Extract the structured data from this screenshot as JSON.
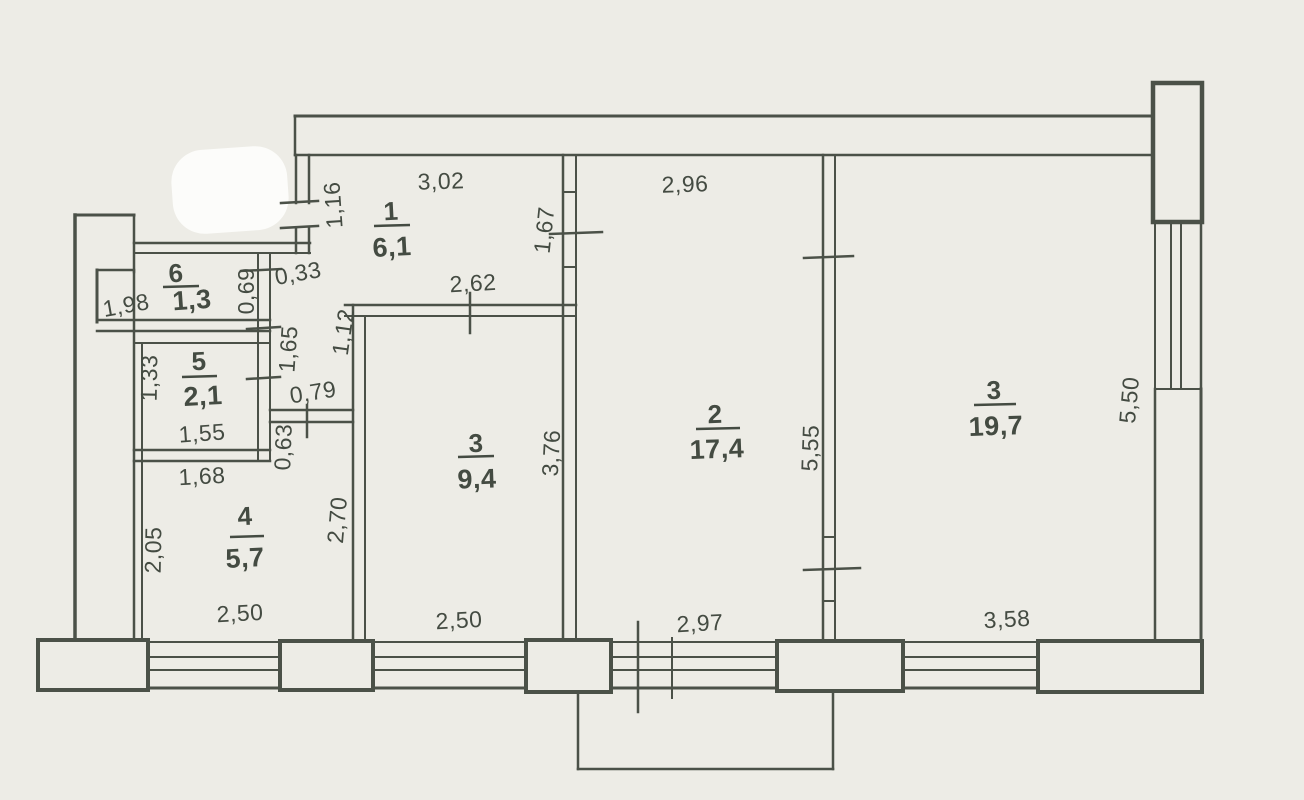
{
  "document": {
    "type": "scanned apartment floor plan",
    "background": "#edece6",
    "line_color": "#4b5148",
    "text_color": "#444b42",
    "erasure_color": "#fcfcfa"
  },
  "plan": {
    "rooms": [
      {
        "number": "1",
        "area": "6,1",
        "nx": 391,
        "ny": 211,
        "ulx1": 374,
        "ulx2": 410,
        "uly": 226,
        "ax": 392,
        "ay": 247,
        "rot": -3
      },
      {
        "number": "6",
        "area": "1,3",
        "nx": 176,
        "ny": 273,
        "ulx1": 163,
        "ulx2": 199,
        "uly": 287,
        "ax": 192,
        "ay": 300,
        "rot": -4
      },
      {
        "number": "5",
        "area": "2,1",
        "nx": 199,
        "ny": 361,
        "ulx1": 182,
        "ulx2": 217,
        "uly": 377,
        "ax": 203,
        "ay": 396,
        "rot": -3
      },
      {
        "number": "4",
        "area": "5,7",
        "nx": 245,
        "ny": 516,
        "ulx1": 230,
        "ulx2": 264,
        "uly": 537,
        "ax": 245,
        "ay": 558,
        "rot": -3
      },
      {
        "number": "3",
        "area": "9,4",
        "nx": 476,
        "ny": 443,
        "ulx1": 458,
        "ulx2": 494,
        "uly": 457,
        "ax": 477,
        "ay": 479,
        "rot": -2
      },
      {
        "number": "2",
        "area": "17,4",
        "nx": 715,
        "ny": 414,
        "ulx1": 696,
        "ulx2": 740,
        "uly": 429,
        "ax": 717,
        "ay": 449,
        "rot": -2
      },
      {
        "number": "3",
        "area": "19,7",
        "nx": 994,
        "ny": 390,
        "ulx1": 974,
        "ulx2": 1016,
        "uly": 405,
        "ax": 996,
        "ay": 426,
        "rot": -2
      }
    ],
    "dimensions": [
      {
        "t": "3,02",
        "x": 441,
        "y": 181,
        "r": -2
      },
      {
        "t": "2,96",
        "x": 685,
        "y": 184,
        "r": -2
      },
      {
        "t": "1,16",
        "x": 333,
        "y": 205,
        "r": -94
      },
      {
        "t": "1,67",
        "x": 544,
        "y": 230,
        "r": -84
      },
      {
        "t": "1,98",
        "x": 126,
        "y": 305,
        "r": -10
      },
      {
        "t": "0,69",
        "x": 246,
        "y": 291,
        "r": -90,
        "fs": 19
      },
      {
        "t": "0,33",
        "x": 298,
        "y": 273,
        "r": -10,
        "fs": 19
      },
      {
        "t": "1,65",
        "x": 288,
        "y": 349,
        "r": -86
      },
      {
        "t": "1,12",
        "x": 343,
        "y": 332,
        "r": -82
      },
      {
        "t": "2,62",
        "x": 473,
        "y": 283,
        "r": -3
      },
      {
        "t": "1,33",
        "x": 149,
        "y": 378,
        "r": -89
      },
      {
        "t": "0,79",
        "x": 313,
        "y": 392,
        "r": -9,
        "fs": 20
      },
      {
        "t": "1,55",
        "x": 202,
        "y": 433,
        "r": -4
      },
      {
        "t": "0,63",
        "x": 283,
        "y": 447,
        "r": -88,
        "fs": 19
      },
      {
        "t": "1,68",
        "x": 202,
        "y": 476,
        "r": -3
      },
      {
        "t": "2,05",
        "x": 153,
        "y": 550,
        "r": -89
      },
      {
        "t": "2,70",
        "x": 337,
        "y": 520,
        "r": -85
      },
      {
        "t": "3,76",
        "x": 551,
        "y": 453,
        "r": -87
      },
      {
        "t": "5,55",
        "x": 810,
        "y": 448,
        "r": -88
      },
      {
        "t": "5,50",
        "x": 1129,
        "y": 400,
        "r": -85
      },
      {
        "t": "2,50",
        "x": 240,
        "y": 613,
        "r": -3
      },
      {
        "t": "2,50",
        "x": 459,
        "y": 620,
        "r": -3
      },
      {
        "t": "2,97",
        "x": 700,
        "y": 623,
        "r": -3
      },
      {
        "t": "3,58",
        "x": 1007,
        "y": 619,
        "r": -3
      }
    ],
    "walls": [
      [
        295,
        116,
        1153,
        116,
        3
      ],
      [
        295,
        155,
        1153,
        155,
        2.5
      ],
      [
        295,
        116,
        295,
        155,
        2.5
      ],
      [
        75,
        215,
        75,
        641,
        3.5
      ],
      [
        75,
        215,
        134,
        215,
        3
      ],
      [
        134,
        215,
        134,
        272,
        2.5
      ],
      [
        97,
        270,
        134,
        270,
        2.5
      ],
      [
        97,
        270,
        97,
        322,
        3
      ],
      [
        134,
        272,
        134,
        641,
        2.5
      ],
      [
        142,
        343,
        142,
        641,
        2
      ],
      [
        134,
        243,
        310,
        243,
        2.5
      ],
      [
        134,
        253,
        310,
        253,
        2
      ],
      [
        97,
        320,
        270,
        320,
        2.5
      ],
      [
        97,
        331,
        270,
        331,
        2.5
      ],
      [
        134,
        343,
        270,
        343,
        2
      ],
      [
        134,
        450,
        270,
        450,
        2.5
      ],
      [
        134,
        461,
        270,
        461,
        2.5
      ],
      [
        258,
        253,
        258,
        461,
        2
      ],
      [
        270,
        253,
        270,
        461,
        2
      ],
      [
        270,
        410,
        353,
        410,
        2.5
      ],
      [
        270,
        422,
        353,
        422,
        2.5
      ],
      [
        296,
        155,
        296,
        203,
        2.5
      ],
      [
        309,
        155,
        309,
        203,
        2.5
      ],
      [
        296,
        228,
        296,
        253,
        2.5
      ],
      [
        309,
        228,
        309,
        253,
        2.5
      ],
      [
        345,
        305,
        576,
        305,
        2.5
      ],
      [
        345,
        316,
        576,
        316,
        2
      ],
      [
        353,
        305,
        353,
        641,
        2.5
      ],
      [
        365,
        316,
        365,
        641,
        2
      ],
      [
        563,
        155,
        563,
        641,
        2.5
      ],
      [
        576,
        155,
        576,
        641,
        2
      ],
      [
        823,
        155,
        823,
        641,
        2.5
      ],
      [
        835,
        155,
        835,
        641,
        2
      ],
      [
        1155,
        389,
        1155,
        643,
        2.5
      ],
      [
        1201,
        389,
        1201,
        688,
        3
      ],
      [
        578,
        691,
        578,
        769,
        2.5
      ],
      [
        578,
        769,
        833,
        769,
        2.5
      ],
      [
        833,
        769,
        833,
        691,
        2.5
      ]
    ],
    "window_lines": [
      [
        148,
        642,
        280,
        642,
        2
      ],
      [
        148,
        657,
        280,
        657,
        2
      ],
      [
        148,
        670,
        280,
        670,
        2
      ],
      [
        148,
        688,
        280,
        688,
        3
      ],
      [
        373,
        642,
        526,
        642,
        2
      ],
      [
        373,
        657,
        526,
        657,
        2
      ],
      [
        373,
        670,
        526,
        670,
        2
      ],
      [
        373,
        688,
        526,
        688,
        3
      ],
      [
        611,
        642,
        777,
        642,
        2
      ],
      [
        611,
        657,
        777,
        657,
        2
      ],
      [
        611,
        670,
        777,
        670,
        2
      ],
      [
        611,
        688,
        777,
        688,
        3
      ],
      [
        903,
        642,
        1038,
        642,
        2
      ],
      [
        903,
        657,
        1038,
        657,
        2
      ],
      [
        903,
        670,
        1038,
        670,
        2
      ],
      [
        903,
        688,
        1038,
        688,
        3
      ],
      [
        1155,
        222,
        1155,
        389,
        2
      ],
      [
        1171,
        222,
        1171,
        389,
        2
      ],
      [
        1181,
        222,
        1181,
        389,
        2
      ],
      [
        1201,
        222,
        1201,
        389,
        2.5
      ],
      [
        1155,
        389,
        1201,
        389,
        2
      ]
    ],
    "piers": [
      [
        38,
        640,
        110,
        50
      ],
      [
        280,
        641,
        93,
        49
      ],
      [
        526,
        640,
        85,
        52
      ],
      [
        777,
        641,
        126,
        50
      ],
      [
        1038,
        641,
        164,
        51
      ]
    ],
    "block": [
      1153,
      83,
      49,
      139
    ],
    "ticks": [
      [
        281,
        203,
        318,
        201,
        2.5
      ],
      [
        281,
        228,
        318,
        226,
        2.5
      ],
      [
        241,
        271,
        281,
        269,
        2.5
      ],
      [
        247,
        329,
        280,
        327,
        2.5
      ],
      [
        247,
        379,
        280,
        377,
        2.5
      ],
      [
        307,
        405,
        307,
        437,
        2.5
      ],
      [
        470,
        293,
        470,
        333,
        2.5
      ],
      [
        550,
        234,
        602,
        232,
        2.5
      ],
      [
        804,
        258,
        853,
        256,
        2.5
      ],
      [
        804,
        570,
        860,
        568,
        2.5
      ],
      [
        638,
        622,
        638,
        712,
        2.5
      ],
      [
        672,
        638,
        672,
        698,
        2
      ],
      [
        563,
        192,
        576,
        192,
        2
      ],
      [
        563,
        267,
        576,
        267,
        2
      ],
      [
        823,
        537,
        835,
        537,
        2
      ],
      [
        823,
        601,
        835,
        601,
        2
      ]
    ],
    "blob": {
      "x": 172,
      "y": 148,
      "w": 116,
      "h": 84,
      "r": 32,
      "rot": -4
    }
  }
}
